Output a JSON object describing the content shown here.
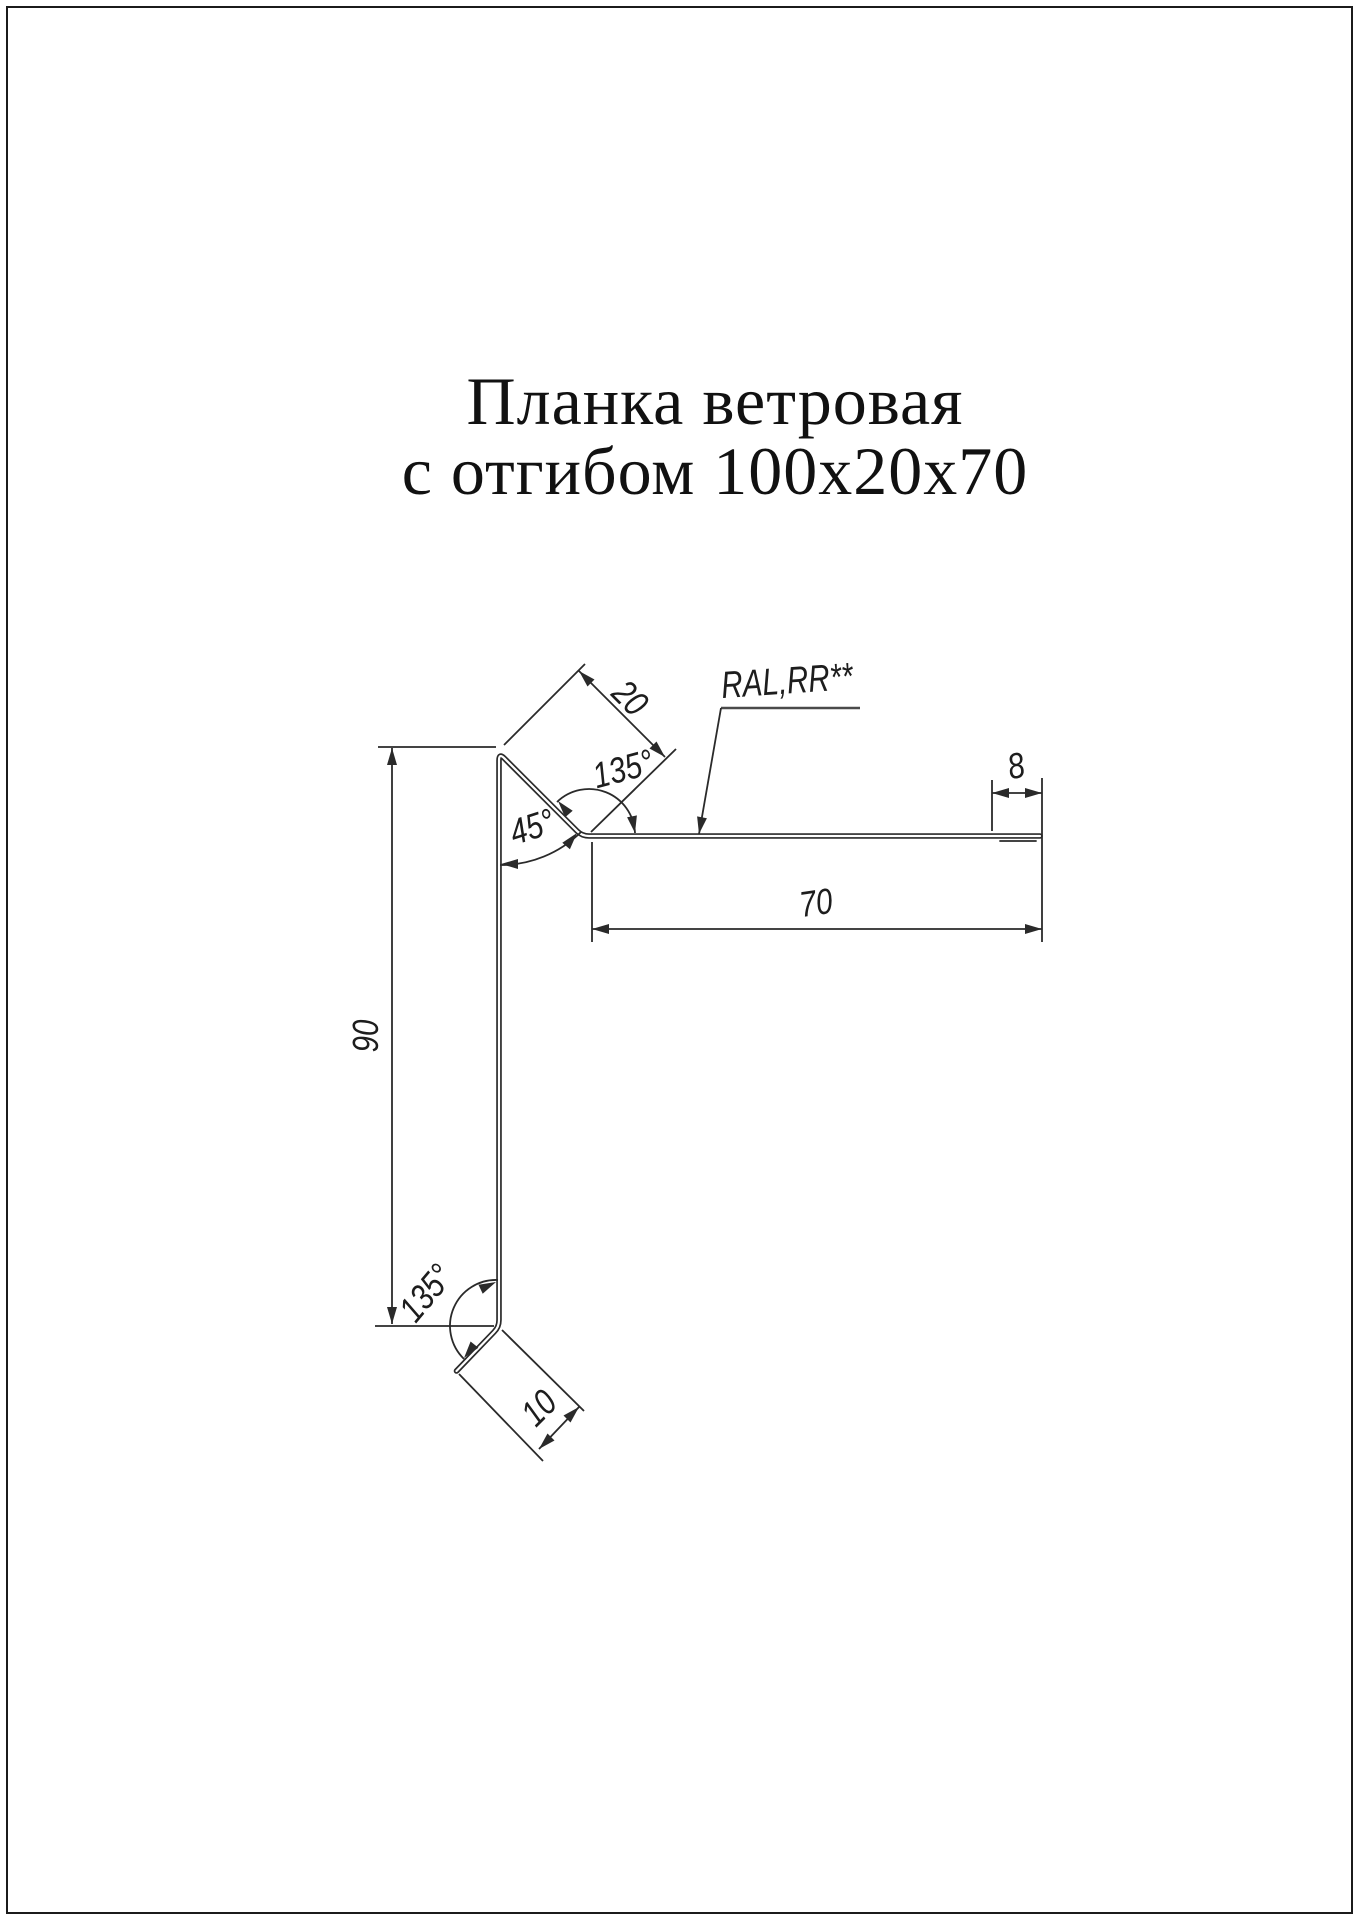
{
  "title": {
    "line1": "Планка ветровая",
    "line2": "с отгибом 100х20х70"
  },
  "annotations": {
    "material": "RAL,RR**"
  },
  "dimensions": {
    "flap_length": "20",
    "top_angle": "135°",
    "apex_angle": "45°",
    "hem_width": "8",
    "top_width": "70",
    "side_height": "90",
    "bottom_angle": "135°",
    "bottom_flange": "10"
  },
  "colors": {
    "line": "#2a2a2a",
    "text": "#1d1d1d",
    "background": "#ffffff"
  }
}
